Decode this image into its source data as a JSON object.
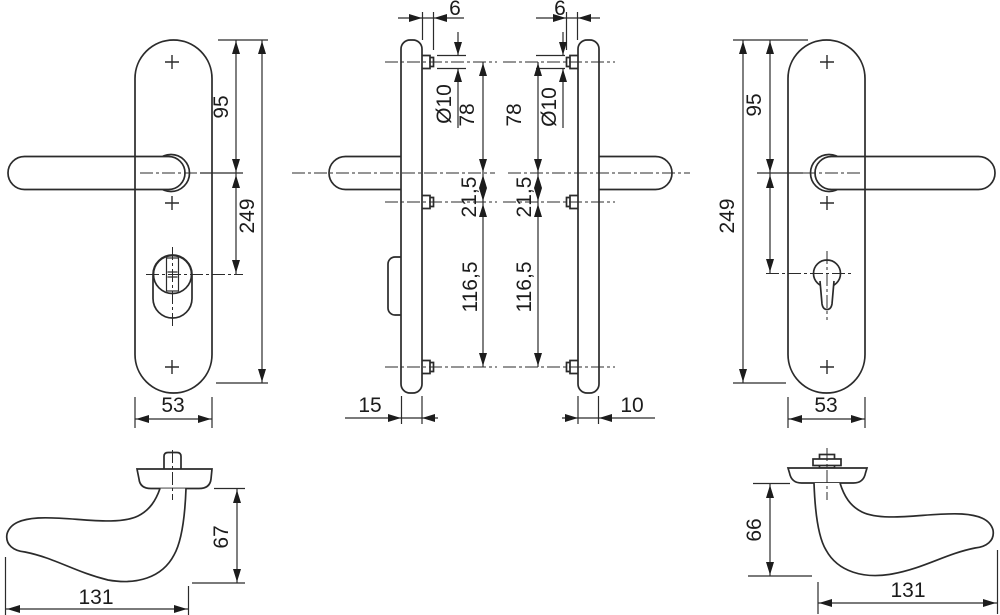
{
  "drawing": {
    "views": {
      "front_left": {
        "handle_offset": "95",
        "height": "249",
        "width": "53"
      },
      "side_left": {
        "pin": "6",
        "pin_dia": "Ø10",
        "top": "78",
        "mid": "21,5",
        "bottom": "116,5",
        "thickness": "15"
      },
      "side_right": {
        "pin": "6",
        "pin_dia": "Ø10",
        "top": "78",
        "mid": "21,5",
        "bottom": "116,5",
        "thickness": "10"
      },
      "front_right": {
        "handle_offset": "95",
        "height": "249",
        "width": "53"
      },
      "handle_left": {
        "height": "67",
        "length": "131"
      },
      "handle_right": {
        "height": "66",
        "length": "131"
      }
    },
    "colors": {
      "line": "#2b2b2b",
      "background": "#ffffff"
    }
  }
}
